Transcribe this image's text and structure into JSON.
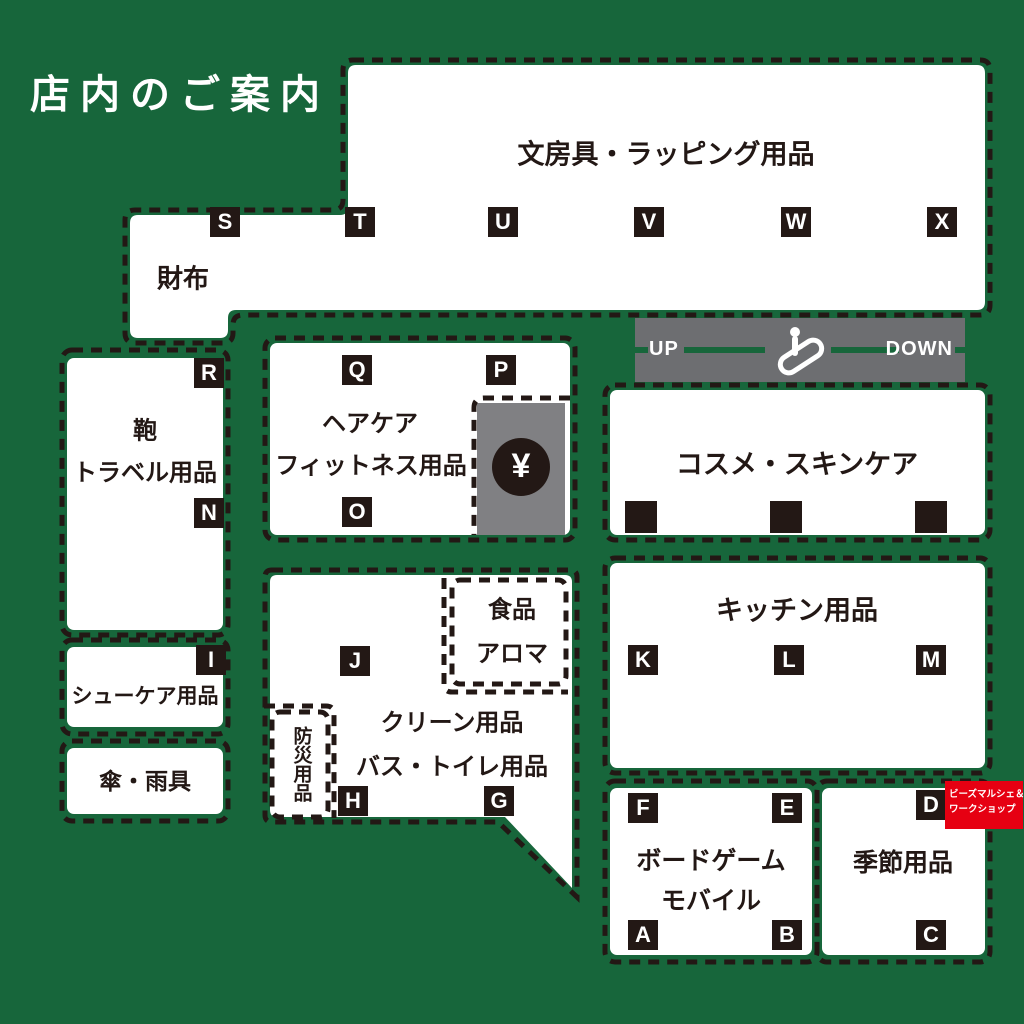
{
  "title": "店内のご案内",
  "colors": {
    "background_green": "#17663b",
    "line_black": "#231815",
    "room_white": "#ffffff",
    "register_gray": "#808083",
    "escalator_gray": "#6d6e71",
    "badge_red": "#e60012"
  },
  "escalator": {
    "up": "UP",
    "down": "DOWN"
  },
  "register_symbol": "¥",
  "badge": {
    "line1": "ビーズマルシェ＆",
    "line2": "ワークショップ"
  },
  "sections": {
    "stationery": {
      "name": "文房具・ラッピング用品",
      "markers": [
        "T",
        "U",
        "V",
        "W",
        "X"
      ]
    },
    "wallet": {
      "name": "財布",
      "markers": [
        "S"
      ]
    },
    "bag_travel": {
      "line1": "鞄",
      "line2": "トラベル用品",
      "markers": [
        "R",
        "N"
      ]
    },
    "shoe_care": {
      "name": "シューケア用品",
      "markers": [
        "I"
      ]
    },
    "umbrella": {
      "name": "傘・雨具"
    },
    "hair_fitness": {
      "line1": "ヘアケア",
      "line2": "フィットネス用品",
      "markers": [
        "Q",
        "P",
        "O"
      ]
    },
    "cosme": {
      "name": "コスメ・スキンケア"
    },
    "kitchen": {
      "name": "キッチン用品",
      "markers": [
        "K",
        "L",
        "M"
      ]
    },
    "clean_bath": {
      "line1": "クリーン用品",
      "line2": "バス・トイレ用品",
      "markers": [
        "J",
        "H",
        "G"
      ]
    },
    "food_aroma": {
      "line1": "食品",
      "line2": "アロマ"
    },
    "disaster": {
      "name": "防災用品"
    },
    "boardgame_mobile": {
      "line1": "ボードゲーム",
      "line2": "モバイル",
      "markers": [
        "F",
        "E",
        "A",
        "B"
      ]
    },
    "seasonal": {
      "name": "季節用品",
      "markers": [
        "D",
        "C"
      ]
    }
  }
}
